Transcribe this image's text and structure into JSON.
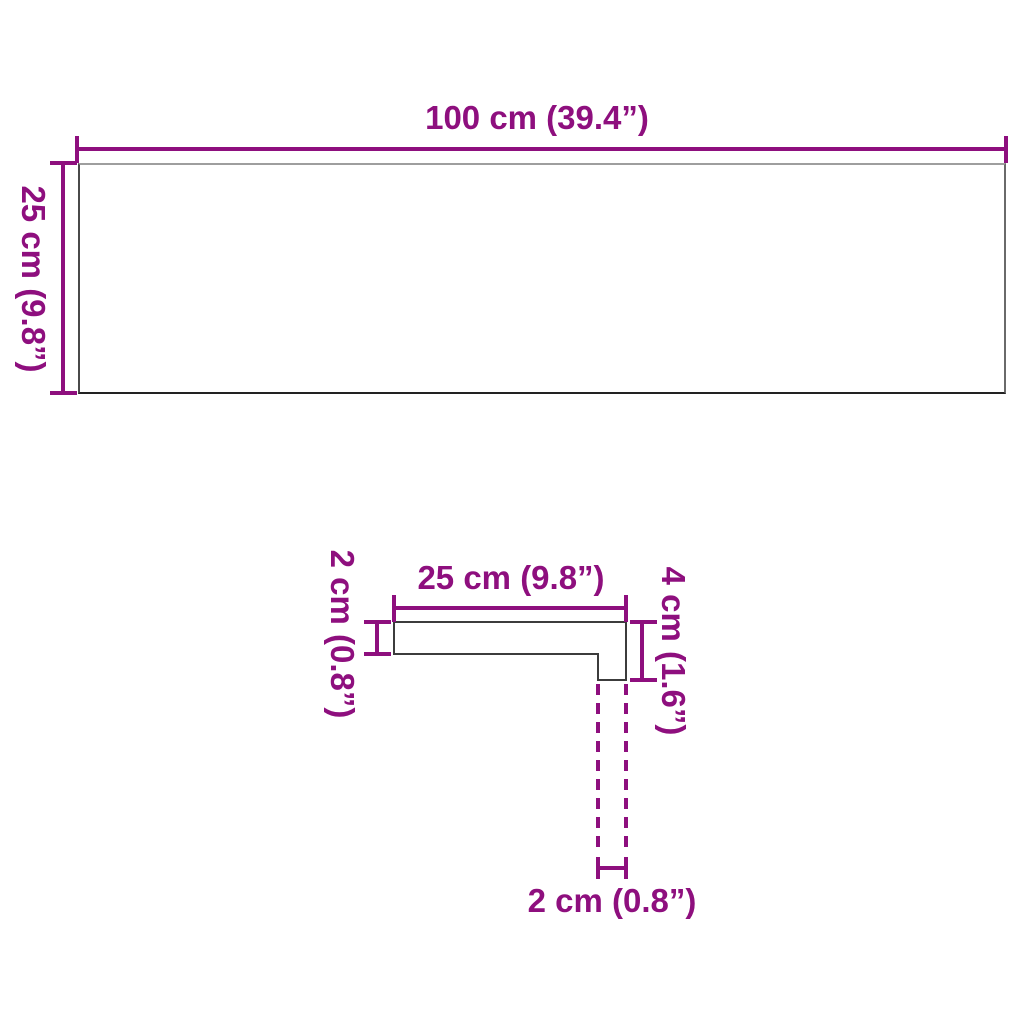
{
  "figure1": {
    "name": "board top view",
    "width_label": "100 cm (39.4”)",
    "height_label": "25 cm (9.8”)"
  },
  "figure2": {
    "name": "board profile cross-section",
    "top_label": "25 cm (9.8”)",
    "left_label": "2 cm (0.8”)",
    "right_label": "4 cm (1.6”)",
    "bottom_label": "2 cm (0.8”)"
  },
  "colors": {
    "dimension_accent": "#8e0f7e",
    "shape_outline": "#3c3c3c",
    "background": "#ffffff"
  }
}
